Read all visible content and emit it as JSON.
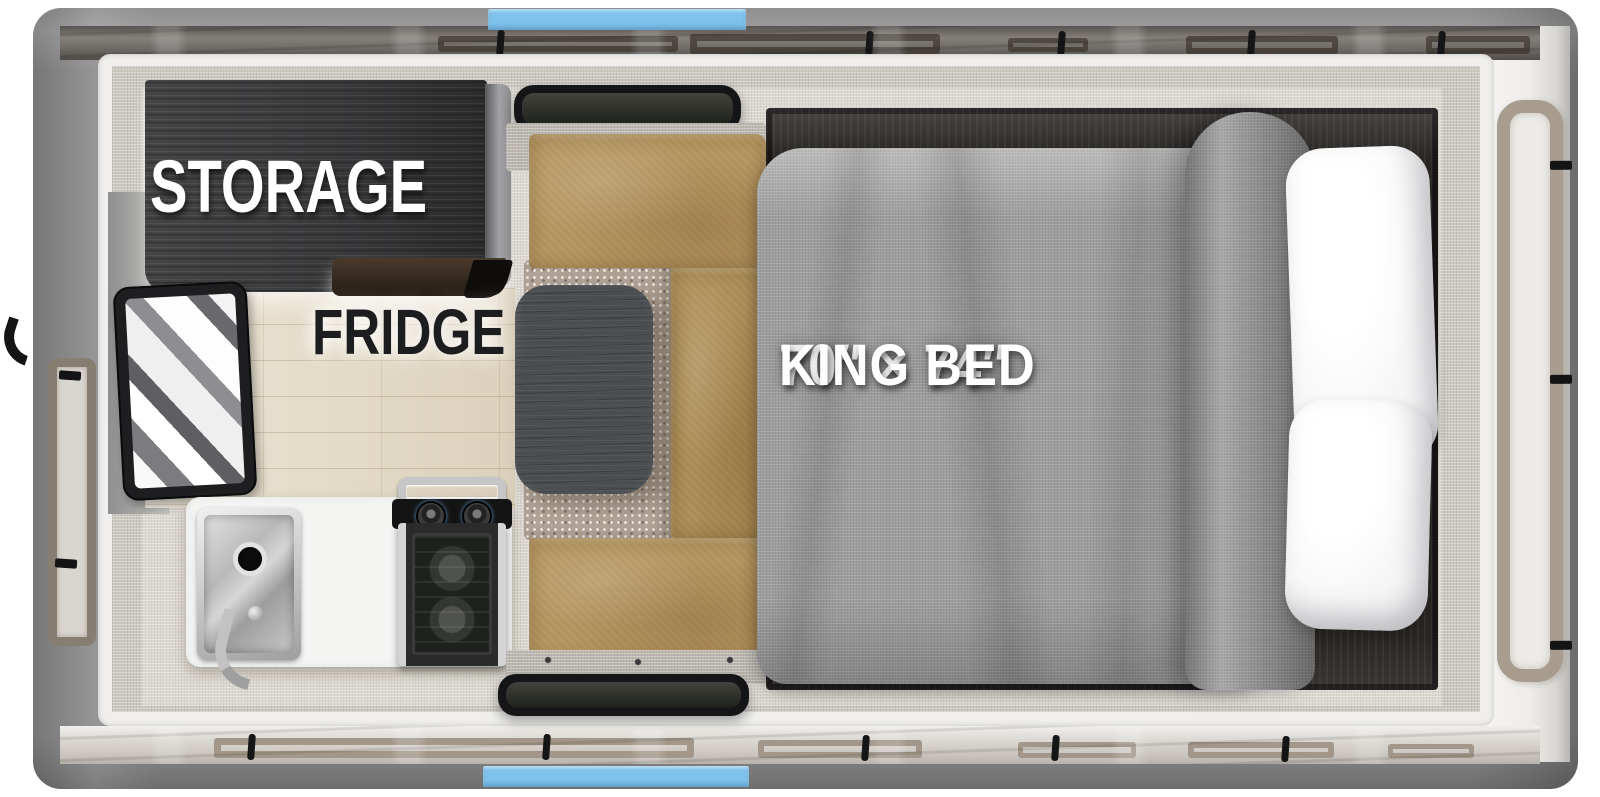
{
  "title": "Truck camper floor plan",
  "labels": {
    "storage": "STORAGE",
    "fridge": "FRIDGE",
    "bed_size": "70″ × 74″",
    "bed_type": "KING BED"
  },
  "colors": {
    "accent_blue": "#7fc3ec",
    "body_gray": "#8a8a8a",
    "canvas_dark": "#6b6763",
    "canvas_light": "#dad6d0",
    "bench_tan": "#b3945e",
    "carpet_taupe": "#b2a496",
    "cabinet_charcoal": "#39393b",
    "table_gray": "#4b4e51",
    "comforter_gray": "#9d9d9d",
    "pillow_white": "#f6f6f7",
    "counter_white": "#f4f4f3",
    "wood_floor": "#e7dfcd",
    "window_frame_tan": "#a79c8e",
    "bed_platform_wood": "#292623"
  },
  "elements": [
    "storage-cabinet",
    "refrigerator",
    "entry-door-glass",
    "kitchen-sink",
    "faucet",
    "two-burner-stove",
    "dinette-table",
    "dinette-bench",
    "dinette-carpet",
    "king-bed",
    "comforter",
    "pillows",
    "front-window",
    "side-window",
    "popup-canvas-top",
    "popup-canvas-bottom",
    "roof-accent-bars"
  ]
}
